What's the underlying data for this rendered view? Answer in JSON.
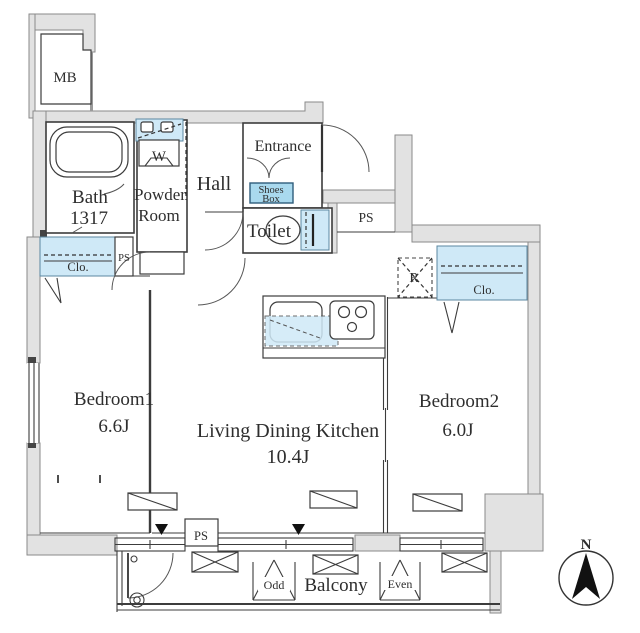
{
  "plan": {
    "title": "apartment-floor-plan",
    "rooms": {
      "bath": {
        "name": "Bath",
        "size": "1317"
      },
      "powder": {
        "line1": "Powder",
        "line2": "Room"
      },
      "hall": {
        "name": "Hall"
      },
      "entrance": {
        "name": "Entrance"
      },
      "shoes_box": {
        "line1": "Shoes",
        "line2": "Box"
      },
      "toilet": {
        "name": "Toilet"
      },
      "bedroom1": {
        "name": "Bedroom1",
        "size": "6.6J"
      },
      "ldk": {
        "name": "Living Dining Kitchen",
        "size": "10.4J"
      },
      "bedroom2": {
        "name": "Bedroom2",
        "size": "6.0J"
      },
      "balcony": {
        "name": "Balcony"
      }
    },
    "labels": {
      "mb": "MB",
      "washer": "W",
      "fridge": "R",
      "ps_top": "PS",
      "ps_left": "PS",
      "ps_bottom": "PS",
      "clo1": "Clo.",
      "clo2": "Clo.",
      "odd": "Odd",
      "even": "Even",
      "compass_north": "N"
    },
    "colors": {
      "wall_fill": "#e2e2e2",
      "closet_blue": "#cfe9f7",
      "shoes_blue": "#a9d9ee",
      "line": "#3c3c3c"
    }
  }
}
